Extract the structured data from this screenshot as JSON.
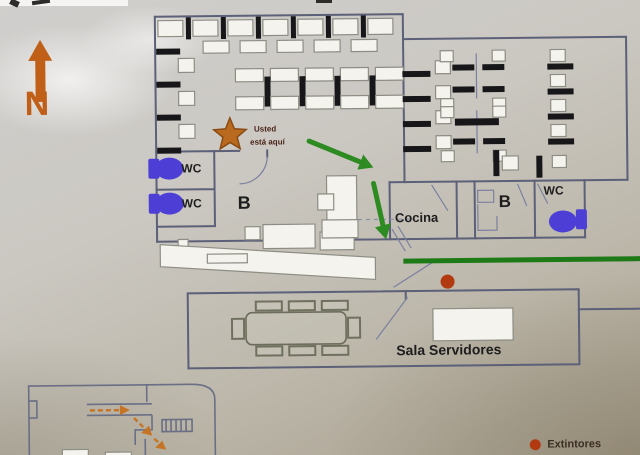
{
  "compass": {
    "label": "N"
  },
  "marker": {
    "you_are_here_line1": "Usted",
    "you_are_here_line2": "está aquí"
  },
  "labels": {
    "wc_left_top": "WC",
    "wc_left_bottom": "WC",
    "b_left": "B",
    "cocina": "Cocina",
    "b_right": "B",
    "wc_right": "WC",
    "sala_servidores": "Sala Servidores"
  },
  "legend": {
    "extinguisher": "Extintores"
  },
  "colors": {
    "compass_orange": "#c06018",
    "route_green": "#2e8b22",
    "assembly_green": "#1d7a16",
    "extinguisher_red": "#b23a10",
    "wc_icon_purple": "#4d3fd6",
    "wall": "#5c6078",
    "inset_route_orange": "#c47424"
  }
}
